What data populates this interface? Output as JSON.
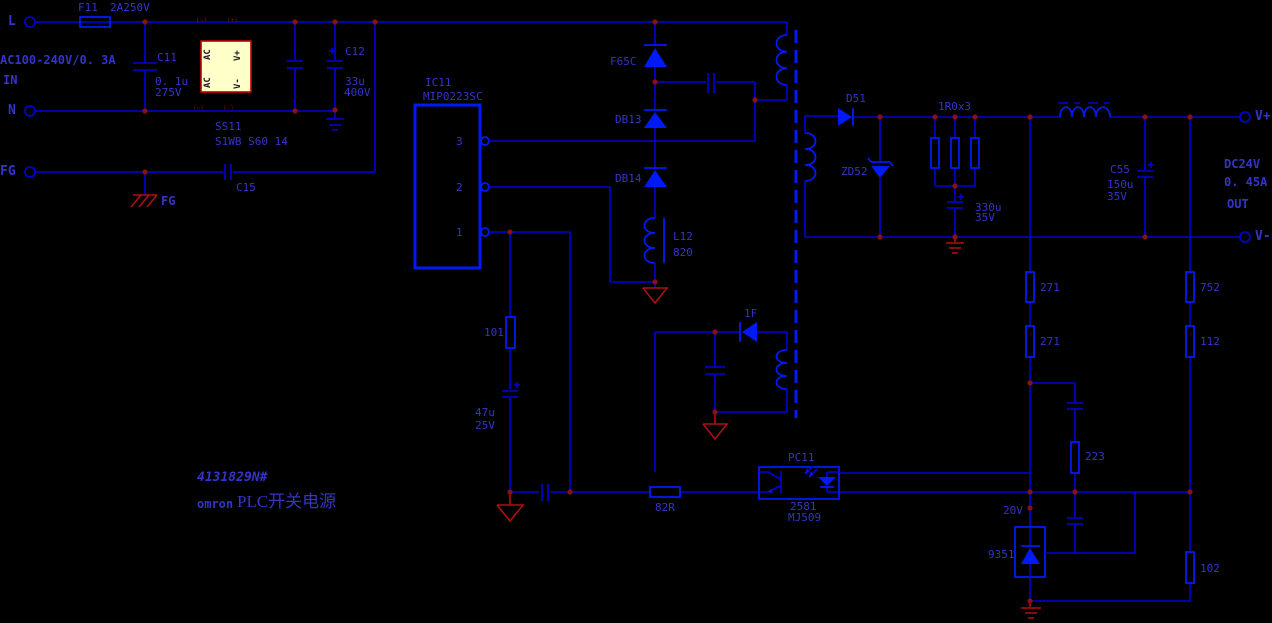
{
  "colors": {
    "background": "#000000",
    "wire": "#0000de",
    "component": "#001af5",
    "text": "#3434c8",
    "junction": "#8b1010",
    "ground_red": "#b01010",
    "bridge_fill": "#ffffc9",
    "bridge_border": "#c00000",
    "bridge_text": "#1a1a30"
  },
  "input": {
    "fuse_ref": "F11",
    "fuse_value": "2A250V",
    "terminal_l": "L",
    "terminal_n": "N",
    "terminal_fg": "FG",
    "rating": "AC100-240V/0. 3A",
    "direction": "IN",
    "c11_ref": "C11",
    "c11_value": "0. 1u",
    "c11_voltage": "275V",
    "c12_ref": "C12",
    "c12_value": "33u",
    "c12_voltage": "400V",
    "c15_ref": "C15",
    "fg_symbol_label": "FG",
    "bridge_ref": "SS11",
    "bridge_part": "S1WB S60 14",
    "bridge_pin_ac1": "AC",
    "bridge_pin_ac2": "AC",
    "bridge_pin_vplus": "V+",
    "bridge_pin_vminus": "V-",
    "bridge_mark_1": "(~)",
    "bridge_mark_2": "(+)",
    "bridge_mark_3": "(~)",
    "bridge_mark_4": "(-)"
  },
  "controller": {
    "ref": "IC11",
    "part": "MIP0223SC",
    "pin_3": "3",
    "pin_2": "2",
    "pin_1": "1"
  },
  "snubber": {
    "f65c": "F65C",
    "db13": "DB13",
    "db14": "DB14",
    "l12_ref": "L12",
    "l12_value": "820"
  },
  "primary_aux": {
    "r101": "101",
    "c47_value": "47u",
    "c47_voltage": "25V",
    "d1f": "1F",
    "r82": "82R"
  },
  "output": {
    "d51": "D51",
    "zd52": "ZD52",
    "r_parallel": "1R0x3",
    "c330_value": "330u",
    "c330_voltage": "35V",
    "c55_ref": "C55",
    "c55_value": "150u",
    "c55_voltage": "35V",
    "terminal_vplus": "V+",
    "terminal_vminus": "V-",
    "rating_voltage": "DC24V",
    "rating_current": "0. 45A",
    "direction": "OUT"
  },
  "feedback": {
    "r271_upper": "271",
    "r271_lower": "271",
    "r752": "752",
    "r112": "112",
    "r223": "223",
    "r102": "102",
    "v20": "20V",
    "shunt_ref": "9351",
    "opto_ref": "PC11",
    "opto_part1": "2581",
    "opto_part2": "MJ509"
  },
  "title_block": {
    "doc_number": "4131829N#",
    "brand": "omron",
    "product": "PLC开关电源"
  }
}
